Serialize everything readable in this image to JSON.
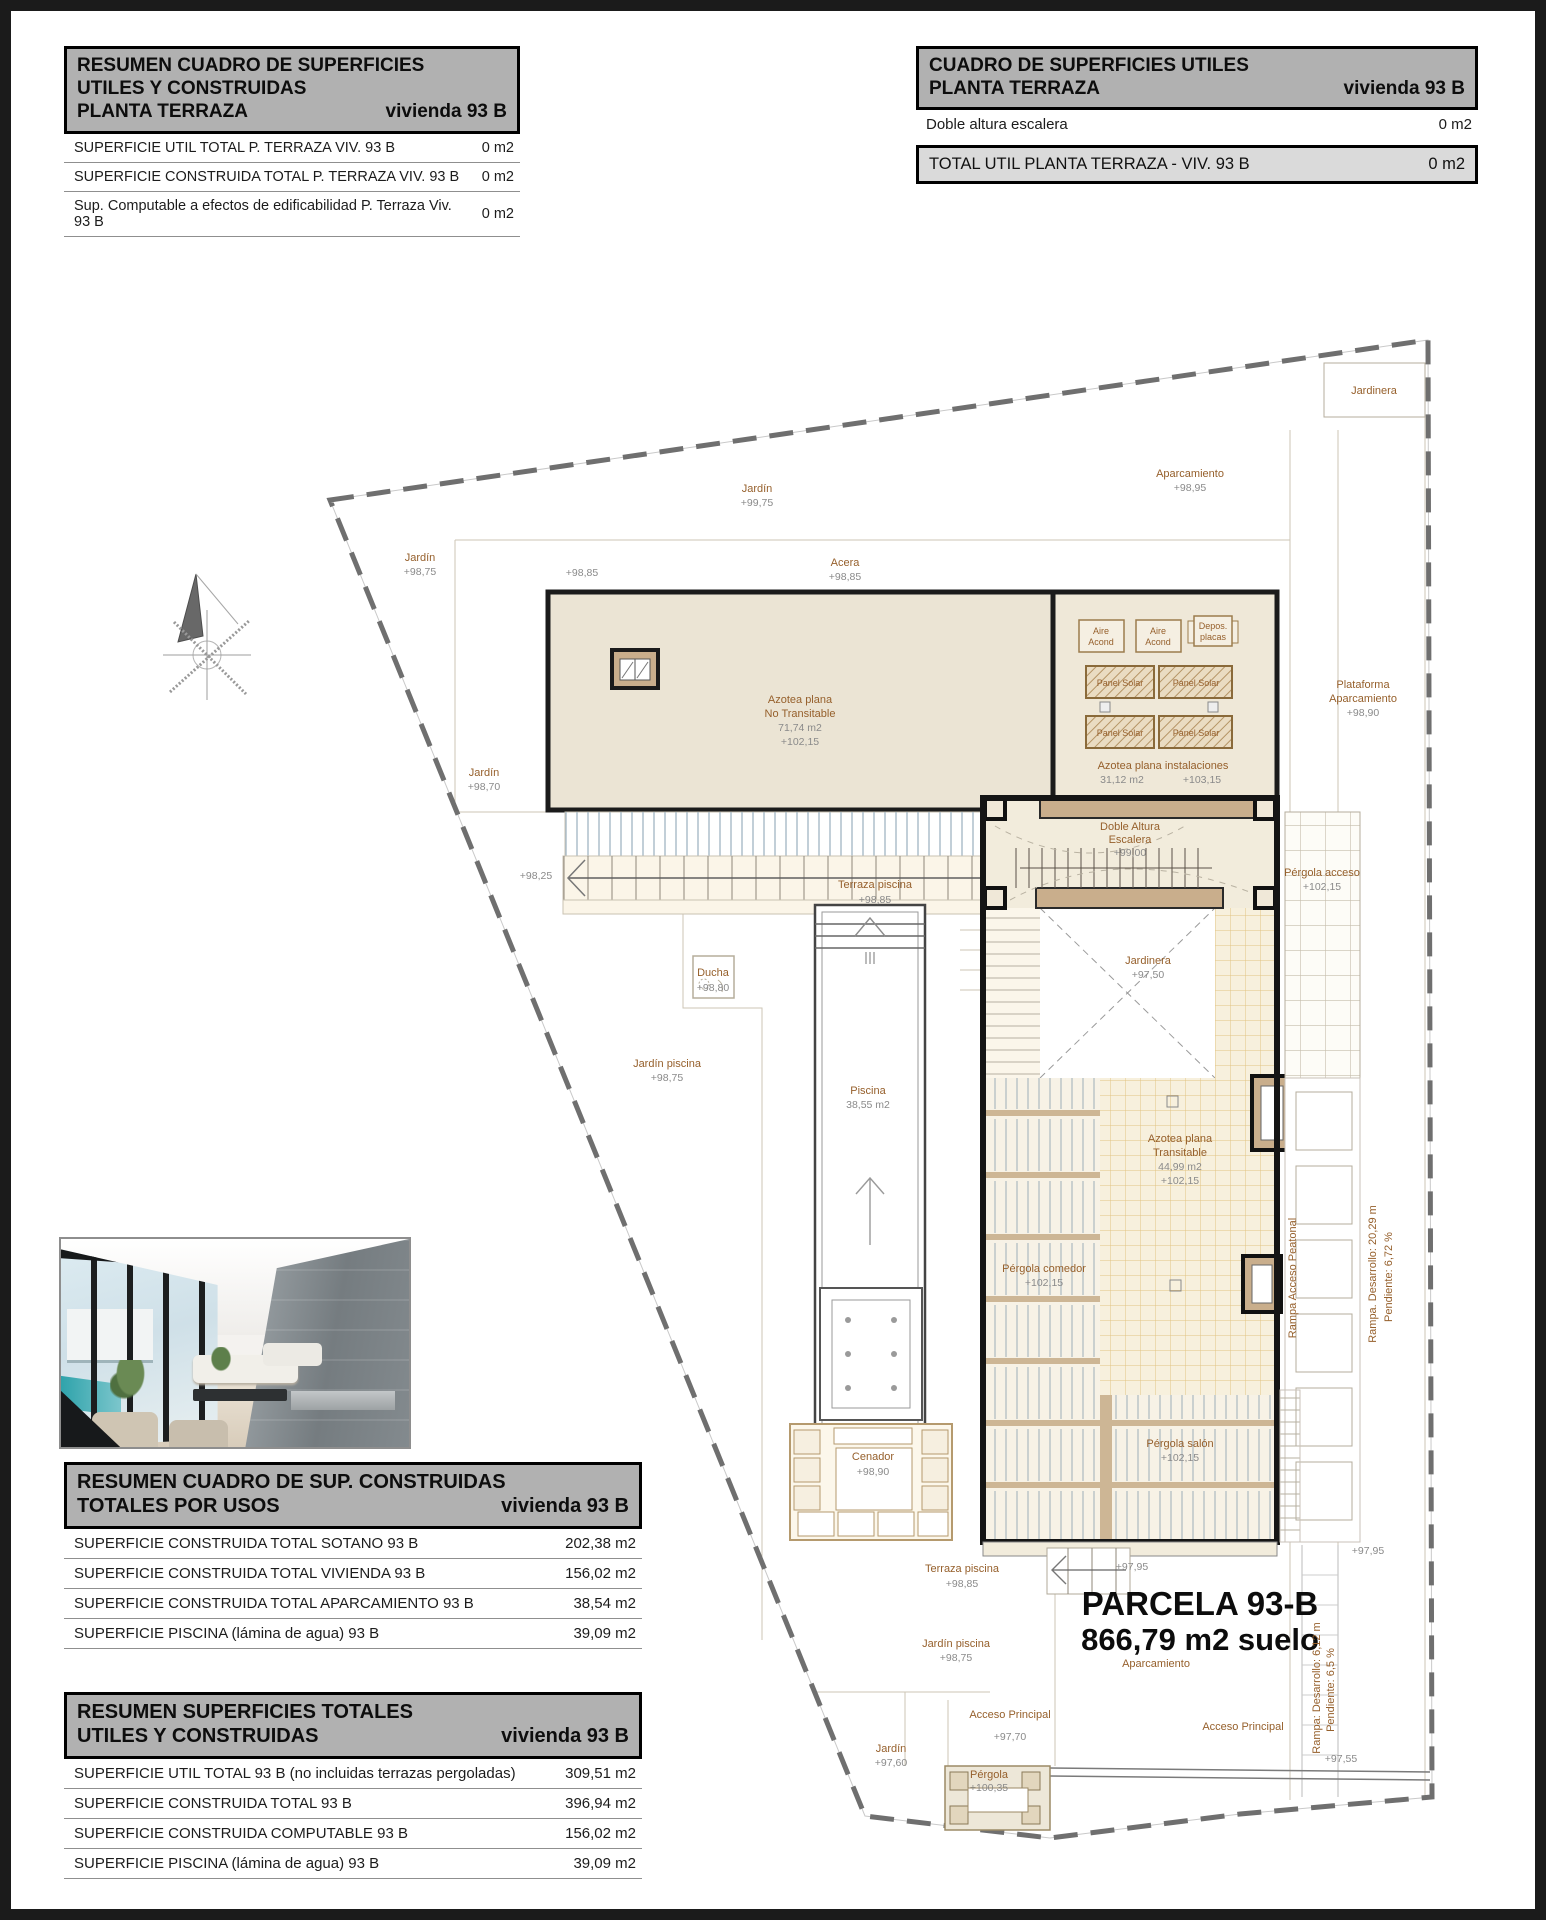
{
  "tables": {
    "top_left": {
      "header_line1": "RESUMEN CUADRO DE SUPERFICIES",
      "header_line2": "UTILES Y CONSTRUIDAS",
      "header_line3": "PLANTA TERRAZA",
      "header_unit": "vivienda 93 B",
      "rows": [
        {
          "label": "SUPERFICIE UTIL TOTAL P. TERRAZA  VIV. 93 B",
          "value": "0 m2"
        },
        {
          "label": "SUPERFICIE CONSTRUIDA TOTAL P. TERRAZA  VIV. 93 B",
          "value": "0 m2"
        },
        {
          "label": "Sup. Computable a efectos de edificabilidad  P. Terraza Viv. 93 B",
          "value": "0 m2"
        }
      ]
    },
    "top_right": {
      "header_line1": "CUADRO DE SUPERFICIES UTILES",
      "header_line2": "PLANTA TERRAZA",
      "header_unit": "vivienda 93 B",
      "rows": [
        {
          "label": "Doble altura escalera",
          "value": "0 m2"
        }
      ],
      "total_label": "TOTAL UTIL PLANTA TERRAZA - VIV.  93 B",
      "total_value": "0 m2"
    },
    "usos": {
      "header_line1": "RESUMEN CUADRO DE SUP. CONSTRUIDAS",
      "header_line2": "TOTALES POR USOS",
      "header_unit": "vivienda 93 B",
      "rows": [
        {
          "label": "SUPERFICIE CONSTRUIDA TOTAL  SOTANO  93 B",
          "value": "202,38 m2"
        },
        {
          "label": "SUPERFICIE CONSTRUIDA TOTAL VIVIENDA 93 B",
          "value": "156,02 m2"
        },
        {
          "label": "SUPERFICIE CONSTRUIDA TOTAL APARCAMIENTO  93 B",
          "value": "38,54 m2"
        },
        {
          "label": "SUPERFICIE PISCINA (lámina de agua)  93 B",
          "value": "39,09 m2"
        }
      ]
    },
    "totales": {
      "header_line1": "RESUMEN SUPERFICIES TOTALES",
      "header_line2": "UTILES Y CONSTRUIDAS",
      "header_unit": "vivienda 93 B",
      "rows": [
        {
          "label": "SUPERFICIE UTIL TOTAL   93 B (no incluidas terrazas pergoladas)",
          "value": "309,51 m2"
        },
        {
          "label": "SUPERFICIE CONSTRUIDA TOTAL  93 B",
          "value": "396,94 m2"
        },
        {
          "label": "SUPERFICIE CONSTRUIDA COMPUTABLE  93 B",
          "value": "156,02 m2"
        },
        {
          "label": "SUPERFICIE PISCINA (lámina de agua)  93 B",
          "value": "39,09 m2"
        }
      ]
    }
  },
  "plan": {
    "jardin_top": [
      "Jardín",
      "+99,75"
    ],
    "jardin_left": [
      "Jardín",
      "+98,75"
    ],
    "acera": [
      "Acera",
      "+98,85"
    ],
    "lvl_acera_left": "+98,85",
    "aparcamiento_top": [
      "Aparcamiento",
      "+98,95"
    ],
    "jardinera_top": "Jardinera",
    "plataforma": [
      "Plataforma",
      "Aparcamiento",
      "+98,90"
    ],
    "jardin_left2": [
      "Jardín",
      "+98,70"
    ],
    "lvl_stair_left": "+98,25",
    "azotea_nt": [
      "Azotea plana",
      "No Transitable",
      "71,74 m2",
      "+102,15"
    ],
    "azotea_inst": [
      "Azotea plana instalaciones",
      "31,12 m2",
      "+103,15"
    ],
    "aire_acond": [
      "Aire",
      "Acond"
    ],
    "depos": [
      "Depos.",
      "placas"
    ],
    "panel_solar": "Panel Solar",
    "doble_altura": [
      "Doble Altura",
      "Escalera",
      "+99,00"
    ],
    "pergola_acceso": [
      "Pérgola acceso",
      "+102,15"
    ],
    "jardinera_mid": [
      "Jardinera",
      "+97,50"
    ],
    "terraza_piscina": [
      "Terraza piscina",
      "+98,85"
    ],
    "ducha": [
      "Ducha",
      "+98,80"
    ],
    "jardin_piscina": [
      "Jardín piscina",
      "+98,75"
    ],
    "piscina": [
      "Piscina",
      "38,55 m2"
    ],
    "pergola_comedor": [
      "Pérgola comedor",
      "+102,15"
    ],
    "azotea_trans": [
      "Azotea plana",
      "Transitable",
      "44,99 m2",
      "+102,15"
    ],
    "rampa_peatonal": "Rampa Acceso Peatonal",
    "rampa_coches": [
      "Rampa. Desarrollo: 20,29 m",
      "Pendiente: 6,72 %"
    ],
    "pergola_salon": [
      "Pérgola salón",
      "+102,15"
    ],
    "cenador": [
      "Cenador",
      "+98,90"
    ],
    "lvl_9795": "+97,95",
    "parcela": [
      "PARCELA  93-B",
      "866,79 m2 suelo"
    ],
    "aparcamiento_bottom": "Aparcamiento",
    "acceso_principal": "Acceso Principal",
    "lvl_9770": "+97,70",
    "rampa_acceso": [
      "Rampa: Desarrollo: 6,12 m",
      "Pendiente: 6,5 %"
    ],
    "lvl_9755": "+97,55",
    "jardin_bottom": [
      "Jardín",
      "+97,60"
    ],
    "pergola_bottom": [
      "Pérgola",
      "+100,35"
    ]
  },
  "colors": {
    "header_gray": "#b1b1b1",
    "total_gray": "#dadada",
    "roof_beige": "#ebe4d4",
    "beam_tan": "#c9ae8c",
    "tile_orange": "#e2c382",
    "label_brown": "#96602c",
    "label_gray": "#8a8a8a",
    "boundary_gray": "#6f6f6f"
  }
}
